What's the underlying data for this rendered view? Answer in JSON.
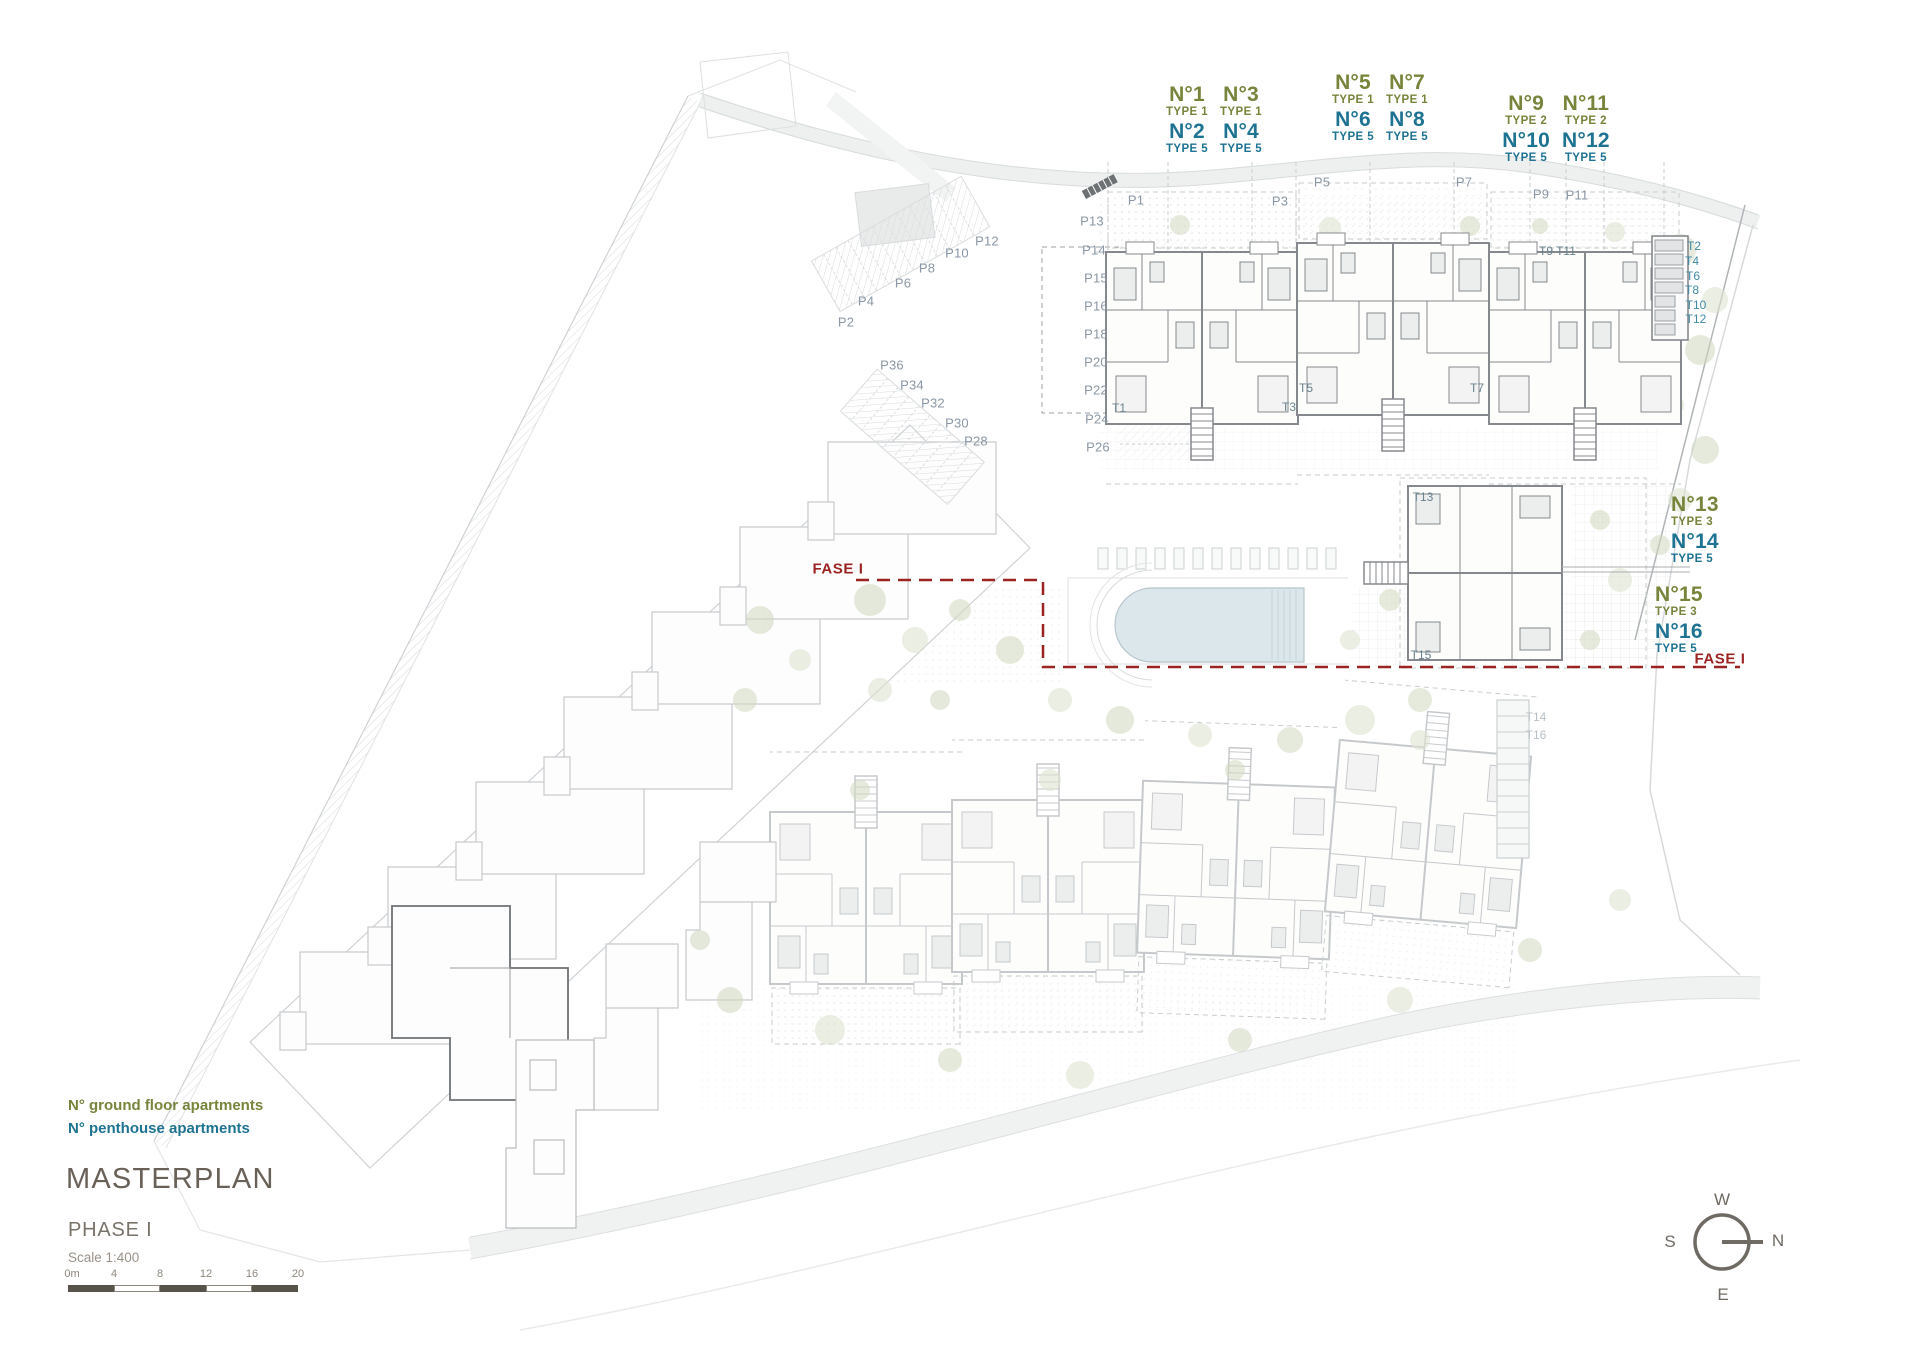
{
  "title_block": {
    "title": "MASTERPLAN",
    "phase": "PHASE I",
    "scale": "Scale 1:400"
  },
  "legend": {
    "ground": "N° ground floor apartments",
    "penthouse": "N° penthouse apartments"
  },
  "colors": {
    "ground_floor": "#76843c",
    "penthouse": "#1e7392",
    "phase_boundary": "#9b2423"
  },
  "phase_labels": {
    "left": "FASE I",
    "right": "FASE I"
  },
  "apartment_groups": [
    {
      "x": 1214,
      "y": 84,
      "cols": 2,
      "k": "ctr",
      "cells": [
        {
          "t": "N°1",
          "k": "g lg"
        },
        {
          "t": "N°3",
          "k": "g lg"
        },
        {
          "t": "TYPE 1",
          "k": "g sm"
        },
        {
          "t": "TYPE 1",
          "k": "g sm"
        },
        {
          "t": "N°2",
          "k": "b lg"
        },
        {
          "t": "N°4",
          "k": "b lg"
        },
        {
          "t": "TYPE 5",
          "k": "b sm"
        },
        {
          "t": "TYPE 5",
          "k": "b sm"
        }
      ]
    },
    {
      "x": 1380,
      "y": 72,
      "cols": 2,
      "k": "ctr",
      "cells": [
        {
          "t": "N°5",
          "k": "g lg"
        },
        {
          "t": "N°7",
          "k": "g lg"
        },
        {
          "t": "TYPE 1",
          "k": "g sm"
        },
        {
          "t": "TYPE 1",
          "k": "g sm"
        },
        {
          "t": "N°6",
          "k": "b lg"
        },
        {
          "t": "N°8",
          "k": "b lg"
        },
        {
          "t": "TYPE 5",
          "k": "b sm"
        },
        {
          "t": "TYPE 5",
          "k": "b sm"
        }
      ]
    },
    {
      "x": 1556,
      "y": 93,
      "cols": 2,
      "k": "ctr",
      "cells": [
        {
          "t": "N°9",
          "k": "g lg"
        },
        {
          "t": "N°11",
          "k": "g lg"
        },
        {
          "t": "TYPE 2",
          "k": "g sm"
        },
        {
          "t": "TYPE 2",
          "k": "g sm"
        },
        {
          "t": "N°10",
          "k": "b lg"
        },
        {
          "t": "N°12",
          "k": "b lg"
        },
        {
          "t": "TYPE 5",
          "k": "b sm"
        },
        {
          "t": "TYPE 5",
          "k": "b sm"
        }
      ]
    },
    {
      "x": 1671,
      "y": 494,
      "cols": 1,
      "k": "lft",
      "cells": [
        {
          "t": "N°13",
          "k": "g lg"
        },
        {
          "t": "TYPE 3",
          "k": "g sm"
        },
        {
          "t": "N°14",
          "k": "b lg"
        },
        {
          "t": "TYPE 5",
          "k": "b sm"
        }
      ]
    },
    {
      "x": 1655,
      "y": 584,
      "cols": 1,
      "k": "lft",
      "cells": [
        {
          "t": "N°15",
          "k": "g lg"
        },
        {
          "t": "TYPE 3",
          "k": "g sm"
        },
        {
          "t": "N°16",
          "k": "b lg"
        },
        {
          "t": "TYPE 5",
          "k": "b sm"
        }
      ]
    }
  ],
  "parking_labels": [
    {
      "t": "P1",
      "x": 1136,
      "y": 200
    },
    {
      "t": "P3",
      "x": 1280,
      "y": 201
    },
    {
      "t": "P5",
      "x": 1322,
      "y": 182
    },
    {
      "t": "P7",
      "x": 1464,
      "y": 182
    },
    {
      "t": "P9",
      "x": 1541,
      "y": 194
    },
    {
      "t": "P11",
      "x": 1577,
      "y": 195
    },
    {
      "t": "P13",
      "x": 1092,
      "y": 221
    },
    {
      "t": "P14",
      "x": 1094,
      "y": 250
    },
    {
      "t": "P15",
      "x": 1096,
      "y": 278
    },
    {
      "t": "P16",
      "x": 1096,
      "y": 306
    },
    {
      "t": "P18",
      "x": 1096,
      "y": 334
    },
    {
      "t": "P20",
      "x": 1096,
      "y": 362
    },
    {
      "t": "P22",
      "x": 1096,
      "y": 390
    },
    {
      "t": "P24",
      "x": 1097,
      "y": 419
    },
    {
      "t": "P26",
      "x": 1098,
      "y": 447
    },
    {
      "t": "P2",
      "x": 846,
      "y": 322
    },
    {
      "t": "P4",
      "x": 866,
      "y": 301
    },
    {
      "t": "P6",
      "x": 903,
      "y": 283
    },
    {
      "t": "P8",
      "x": 927,
      "y": 268
    },
    {
      "t": "P10",
      "x": 957,
      "y": 253
    },
    {
      "t": "P12",
      "x": 987,
      "y": 241
    },
    {
      "t": "P28",
      "x": 976,
      "y": 441
    },
    {
      "t": "P30",
      "x": 957,
      "y": 423
    },
    {
      "t": "P32",
      "x": 933,
      "y": 403
    },
    {
      "t": "P34",
      "x": 912,
      "y": 385
    },
    {
      "t": "P36",
      "x": 892,
      "y": 365
    }
  ],
  "storage_labels": [
    {
      "t": "T1",
      "x": 1119,
      "y": 408
    },
    {
      "t": "T3",
      "x": 1289,
      "y": 407
    },
    {
      "t": "T5",
      "x": 1306,
      "y": 388
    },
    {
      "t": "T7",
      "x": 1477,
      "y": 388
    },
    {
      "t": "T9",
      "x": 1546,
      "y": 251
    },
    {
      "t": "T11",
      "x": 1566,
      "y": 251
    },
    {
      "t": "T2",
      "x": 1694,
      "y": 246,
      "k": "teal"
    },
    {
      "t": "T4",
      "x": 1692,
      "y": 261,
      "k": "teal"
    },
    {
      "t": "T6",
      "x": 1693,
      "y": 276,
      "k": "teal"
    },
    {
      "t": "T8",
      "x": 1692,
      "y": 290,
      "k": "teal"
    },
    {
      "t": "T10",
      "x": 1696,
      "y": 305,
      "k": "teal"
    },
    {
      "t": "T12",
      "x": 1696,
      "y": 319,
      "k": "teal"
    },
    {
      "t": "T13",
      "x": 1423,
      "y": 497
    },
    {
      "t": "T15",
      "x": 1421,
      "y": 655
    },
    {
      "t": "T14",
      "x": 1536,
      "y": 717,
      "k": "faded"
    },
    {
      "t": "T16",
      "x": 1536,
      "y": 735,
      "k": "faded"
    }
  ],
  "compass": {
    "top": "W",
    "left": "S",
    "right": "N",
    "bottom": "E"
  },
  "scalebar": {
    "ticks": [
      {
        "t": "0m",
        "x": 72
      },
      {
        "t": "4",
        "x": 114
      },
      {
        "t": "8",
        "x": 160
      },
      {
        "t": "12",
        "x": 206
      },
      {
        "t": "16",
        "x": 252
      },
      {
        "t": "20",
        "x": 298
      }
    ]
  }
}
